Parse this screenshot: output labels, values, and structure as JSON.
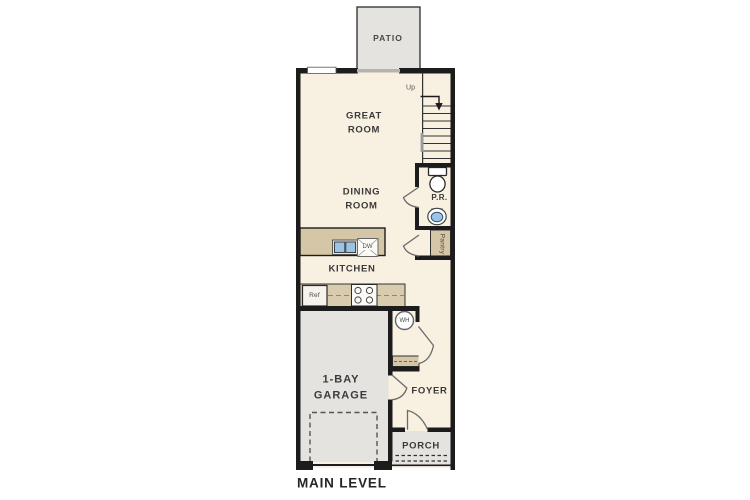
{
  "plan": {
    "level_title": "MAIN LEVEL",
    "patio": "PATIO",
    "great_room": [
      "GREAT",
      "ROOM"
    ],
    "dining_room": [
      "DINING",
      "ROOM"
    ],
    "kitchen": "KITCHEN",
    "powder_room": "P.R.",
    "pantry": "Pantry",
    "garage": [
      "1-BAY",
      "GARAGE"
    ],
    "foyer": "FOYER",
    "porch": "PORCH",
    "stairs_up": "Up",
    "fixtures": {
      "refrigerator": "Ref",
      "dishwasher": "DW",
      "water_heater": "WH"
    }
  },
  "colors": {
    "wall": "#1c1c1c",
    "floor": "#f8f0e1",
    "concrete": "#e4e3e0",
    "casework": "#d5c6a7",
    "counter": "#d9ccae",
    "sink_blue": "#9cc2e5",
    "label": "#3a3a3a"
  }
}
